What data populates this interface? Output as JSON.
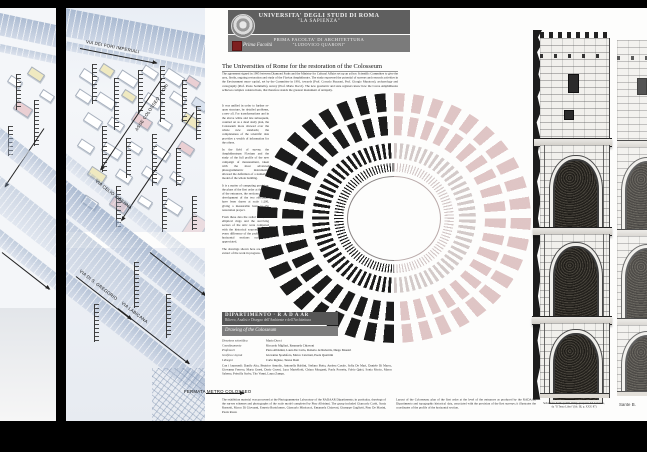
{
  "banner": {
    "line1": "UNIVERSITA' DEGLI STUDI DI ROMA",
    "line2": "\"LA SAPIENZA\"",
    "line3": "PRIMA FACOLTA' DI ARCHITETTURA",
    "line4": "\"LUDOVICO QUARONI\"",
    "seal_icon": "university-seal",
    "signature": "Prima Facoltà"
  },
  "article": {
    "title": "The Universities of Rome for the restoration of the Colosseum",
    "intro": "The agreement signed in 1995 between Diamond Parks and the Ministry for Cultural Affairs set up an ad hoc Scientific Committee to give the area, firstly, ongoing restoration and study of the Flavian Amphitheatre. The study expressed the potential of surveys and research activities in the Environment more capital, set by the Committee in 1991, towards (Prof. Corrado Bozzoni, Prof. Giorgio Muratore), archaeology and cartography (Prof. Paolo Sommella), survey (Prof. Mario Docci). The new geometric and state registers know how the Cavea Amphitheatre achieves complex constructions, that therefore stands the greatest monument of antiquity.",
    "col1": "It was unified in order to further re-open structure, by detailed problems, a new all. For transformations and in the above white and late subsequent, counted on as a dead study plan, the Colosseum more showed over the whole new standards; the completeness of the scientific data provides a wealth of information for the others.",
    "col2": "In the field of survey, the Amphitheatrum Flavium and the study of the full profile of the new campaign of measurement, taken with the most advanced photogrammetric instruments, allowed the definition of a numerical model of the whole building.",
    "col3": "It is a matter of computing precision: the plans of the first order at the level of the entrances, the sections and the development of the two elevations have been drawn at scale 1:200, giving a measurable basis to the restoration project.",
    "col4": "From these data the radial walls, the elliptical rings and the surviving sectors of the attic were compared with the historical sources, so that every difference of the profile of the horizontal sections could be appreciated.",
    "col5": "The drawings shown here are a first extract of the work in progress."
  },
  "credits": {
    "dept": "DIPARTIMENTO  ·  R A D A AR",
    "dept_sub": "Rilievo, Analisi e Disegno dell'Ambiente e dell'Architettura",
    "project": "Drawing of the Colosseum",
    "rows": [
      {
        "label": "Direzione scientifica",
        "value": "Mario Docci"
      },
      {
        "label": "Coordinamento",
        "value": "Riccardo Migliari, Emanuela Chiavoni"
      },
      {
        "label": "Professori",
        "value": "Piero Albisinni, Laura De Carlo, Roberto de Rubertis, Diego Maestri"
      },
      {
        "label": "Grafica e layout",
        "value": "Giovanna Spadafora, Marco Canciani, Paola Quattrini"
      },
      {
        "label": "I disegni",
        "value": "Carlo Inglese, Teresa Doni"
      }
    ],
    "students_label": "Con i laureandi:",
    "students": "Danilo Aita, Beatrice Amodio, Antonella Baldini, Stefano Botta, Andrea Casale, Sofia De Mari, Daniele Di Marco, Giovanna Ferrero, Marta Gnesi, Dario Grossi, Luca Martellotti, Chiara Morganti, Paola Porretta, Fabio Quici, Sonia Riccio, Marco Salerno, Priscilla Sorbo, Tito Vanni, Laura Zampa."
  },
  "captions": {
    "left": "The exhibition material was processed at the Photogrammetry Laboratory of the RADAAR Dipartimento; in particular, drawings of the survey schemes and photographs of the scale model completed by Pino Albisinni. The group included Giancarlo Carbi, Sonia Russotti, Marco Di Giovanni, Ernesto Bartolomeo, Giancarlo Minicucci, Emanuela Chiavoni, Giuseppe Gugliotti, Pino De Masini, Paola Rossi.",
    "right": "Layout of the Colosseum: plan of the first order at the level of the entrances as produced by the RADAAR Dipartimento and topographic historical data, associated with the precision of the first surveys; it illustrates the coordinates of the profile of the horizontal section.",
    "elevation1": "Sebastiano Serlio (1475-1554), prospetto del Colosseo,",
    "elevation2": "da \"Il Terzo Libro\" (lib. III, p. XXV, 87)",
    "edge": "Sante B."
  },
  "map": {
    "labels": {
      "top": "VIA DEI FORI IMPERIALI",
      "diag1": "ASSE COLOSSEO - FORI",
      "diag2": "VIA CELIO VIBENNA",
      "low1": "VIA DI S. GREGORIO",
      "low2": "VIA LABICANA",
      "bottom": "FERMATA METRO COLOSSEO"
    }
  },
  "colors": {
    "page_bg": "#000000",
    "poster_bg": "#fdfdfc",
    "banner_grey": "#5f5f5f",
    "banner_sub_grey": "#7b7b7b",
    "accent_red": "#7e1f1f",
    "map_blue": "#b9c8dc",
    "block_yellow": "#efe9c0",
    "block_pink": "#eacfd3",
    "plan_ink": "#1c1c1c",
    "plan_faint_pink": "#c18e8e"
  }
}
